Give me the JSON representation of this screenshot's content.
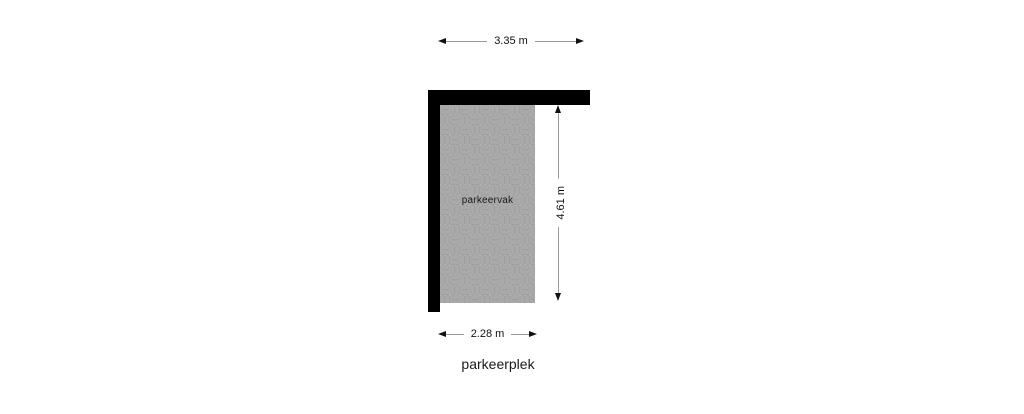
{
  "title": "parkeerplek",
  "floorplan": {
    "area_label": "parkeervak",
    "dimensions": {
      "top": "3.35 m",
      "right": "4.61 m",
      "bottom": "2.28 m"
    }
  },
  "colors": {
    "background": "#ffffff",
    "wall": "#000000",
    "paving_brick": "#a9a9a9",
    "paving_joint": "#c8c8c8",
    "paving_brick_outline": "#8f8f8f",
    "dimension_line": "#9a9a9a",
    "text": "#1a1a1a"
  }
}
